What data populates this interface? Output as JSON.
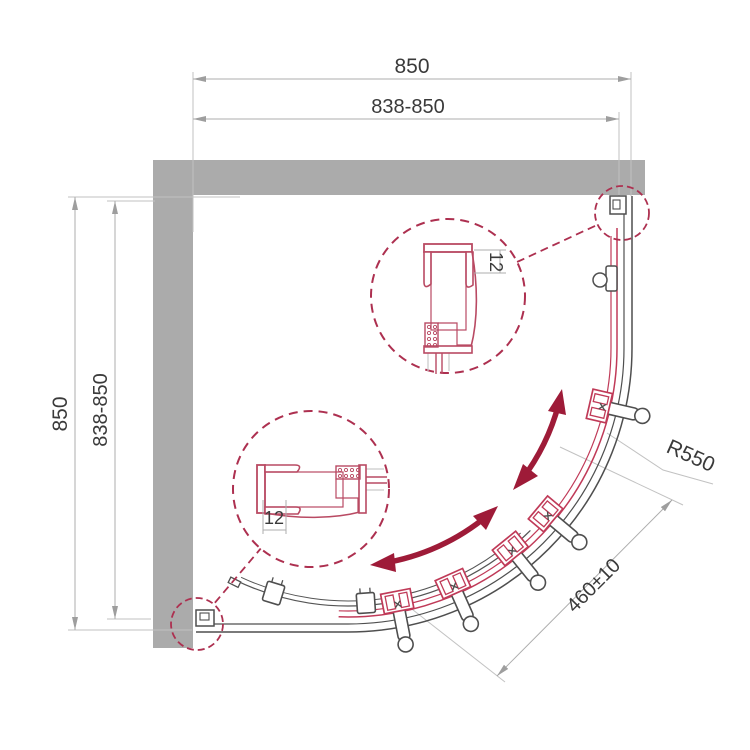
{
  "meta": {
    "type": "technical-drawing",
    "subject": "quadrant shower enclosure plan view"
  },
  "labels": {
    "dim_top_overall": "850",
    "dim_top_range": "838-850",
    "dim_left_overall": "850",
    "dim_left_range": "838-850",
    "radius_label": "R550",
    "entry_width": "460±10",
    "detail_upper_adjust": "12",
    "detail_lower_adjust": "12"
  },
  "colors": {
    "wall": "#ABABAB",
    "dark_line": "#4F4F4F",
    "red_line": "#C03A58",
    "detail_red": "#B94A63",
    "dashed_red": "#AD3050",
    "arrow_red": "#9E1B38",
    "dim_line": "#ADADAD",
    "dim_text": "#3A3A3A",
    "background": "#FFFFFF"
  }
}
